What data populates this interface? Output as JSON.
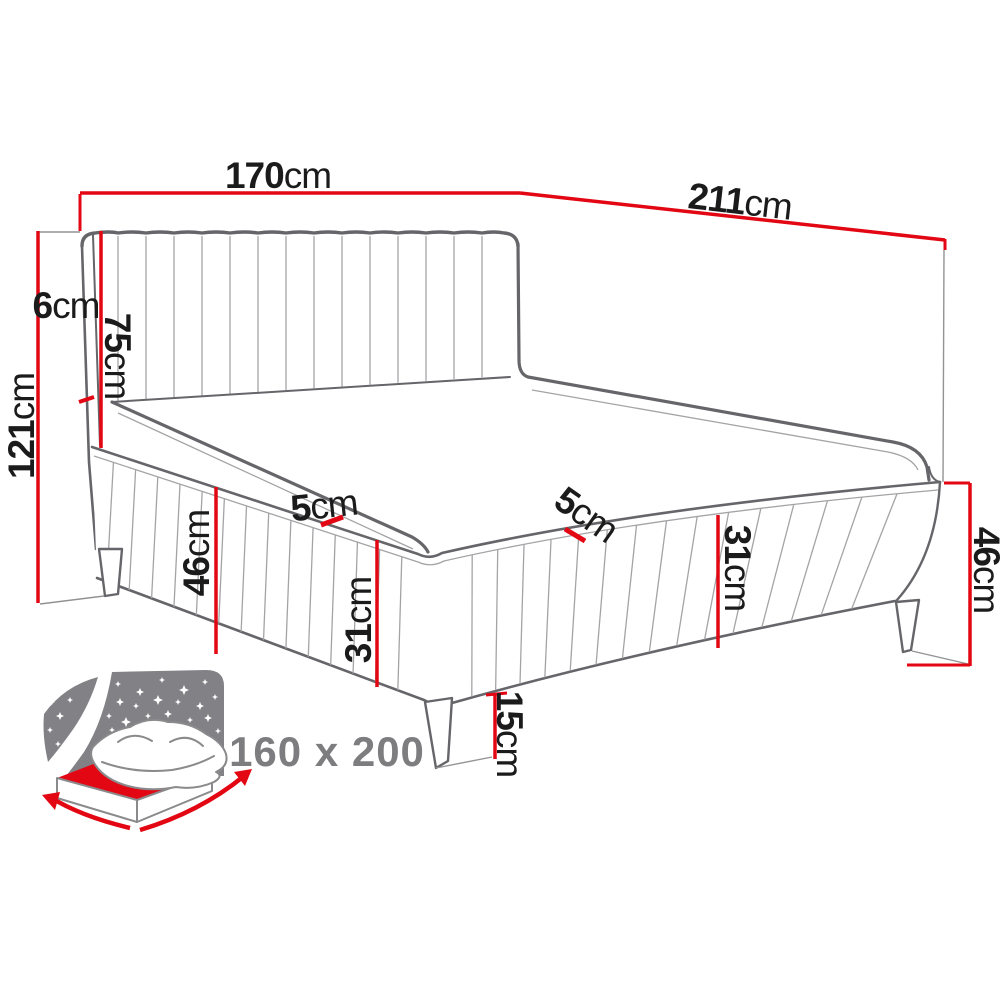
{
  "dims": {
    "width": {
      "value": "170",
      "unit": "cm"
    },
    "length": {
      "value": "211",
      "unit": "cm"
    },
    "headboard_depth": {
      "value": "6",
      "unit": "cm"
    },
    "headboard_height": {
      "value": "75",
      "unit": "cm"
    },
    "total_height": {
      "value": "121",
      "unit": "cm"
    },
    "base_height_left": {
      "value": "46",
      "unit": "cm"
    },
    "piping_left": {
      "value": "5",
      "unit": "cm"
    },
    "rail_height_left": {
      "value": "31",
      "unit": "cm"
    },
    "piping_right": {
      "value": "5",
      "unit": "cm"
    },
    "rail_height_right": {
      "value": "31",
      "unit": "cm"
    },
    "base_height_right": {
      "value": "46",
      "unit": "cm"
    },
    "leg_height": {
      "value": "15",
      "unit": "cm"
    }
  },
  "size_label": "160 x 200",
  "icon": {
    "name": "bed-starry-night-icon"
  },
  "colors": {
    "dimension_red": "#e30613",
    "text_black": "#1b1b1b",
    "outline_gray": "#66666a",
    "seam_gray": "#a4a4a7",
    "size_text_gray": "#7d7d80",
    "icon_panel_gray": "#828286"
  }
}
